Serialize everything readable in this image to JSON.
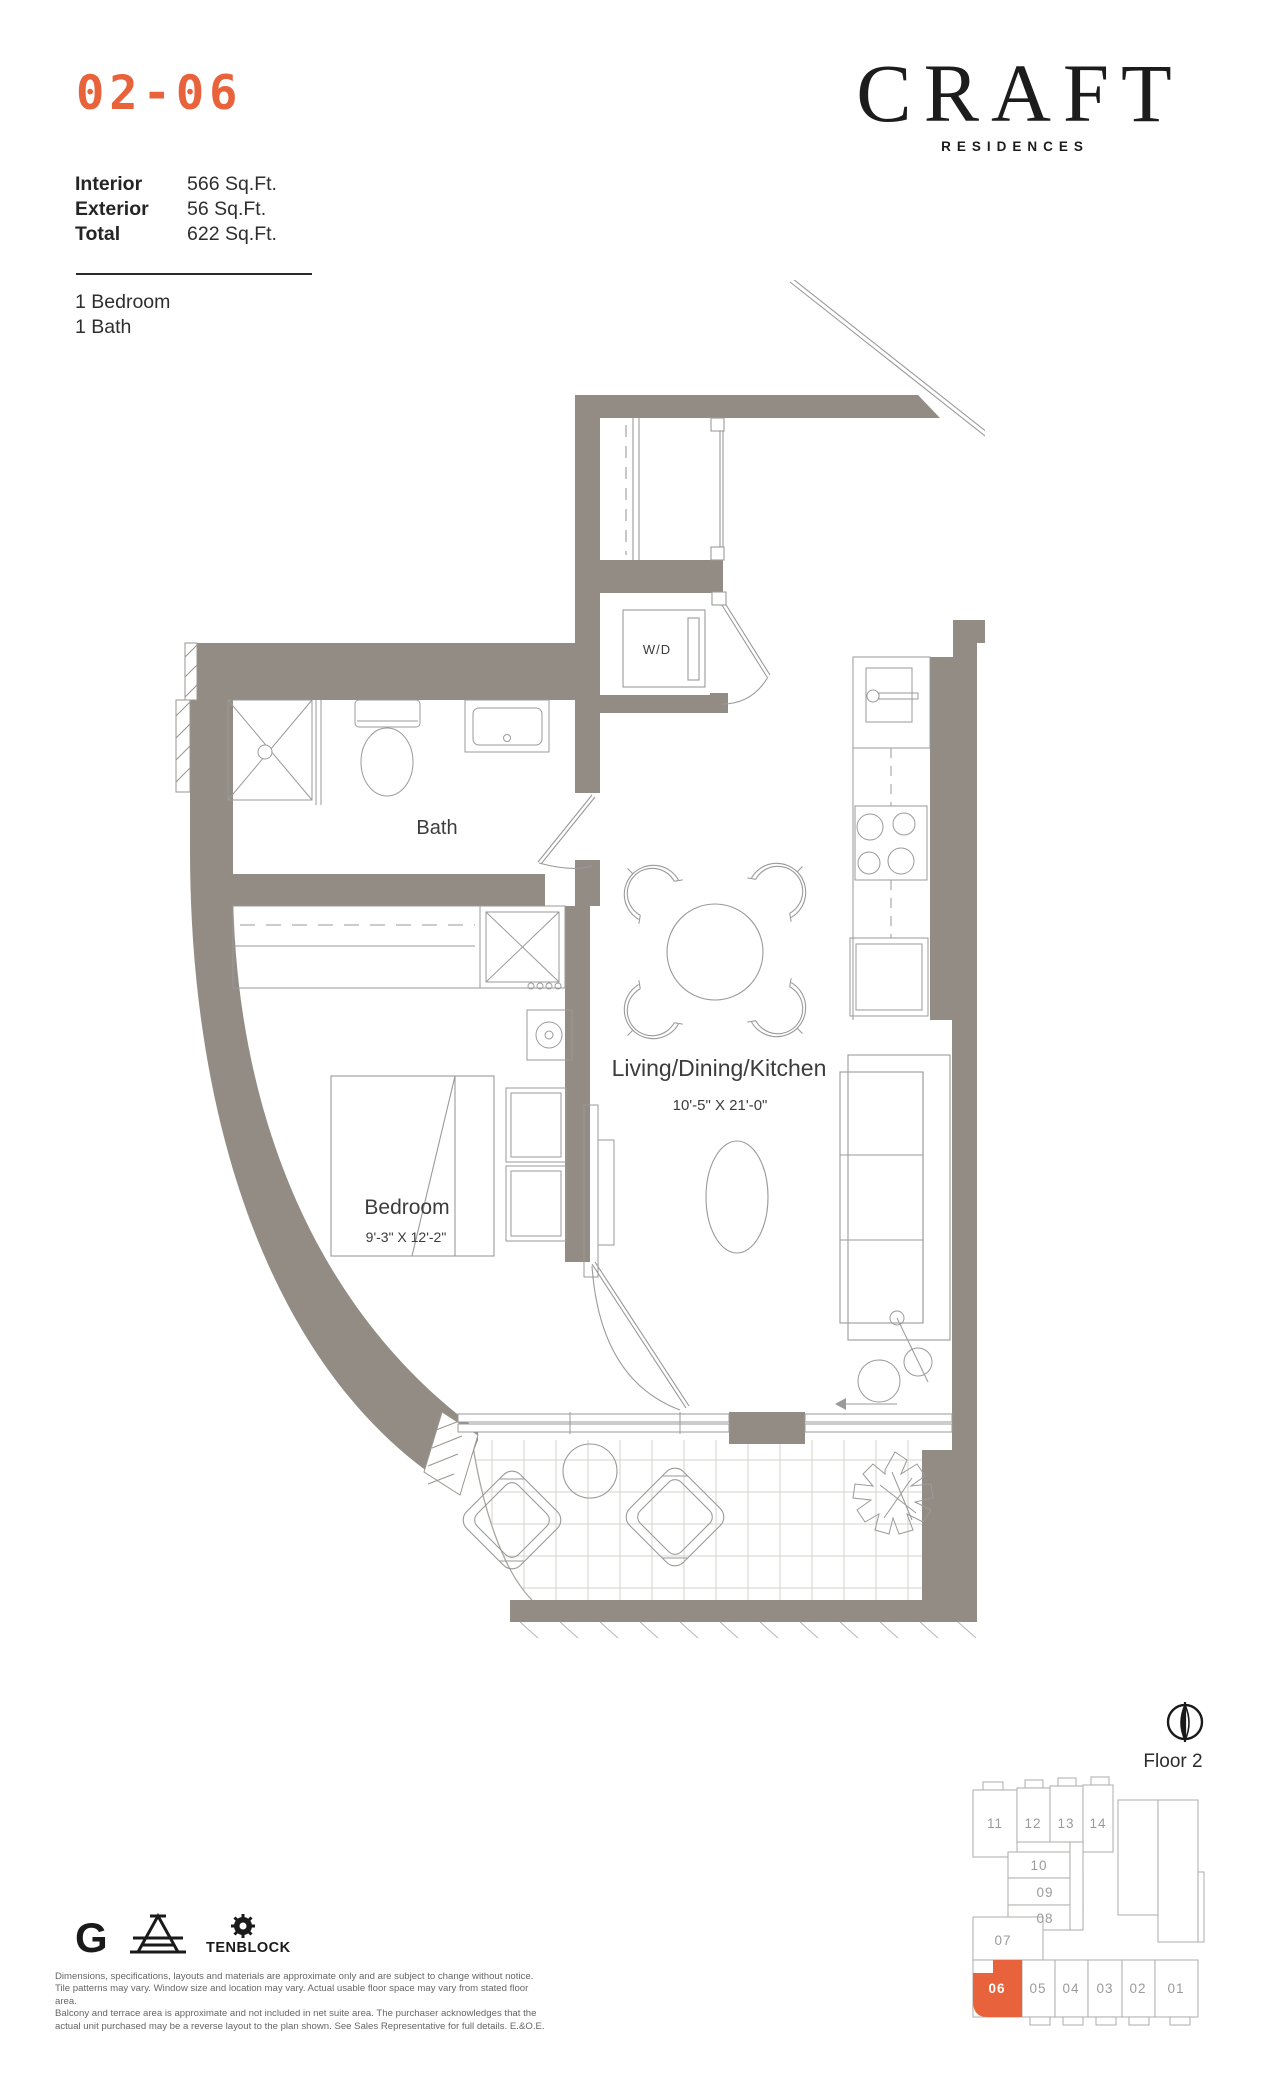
{
  "colors": {
    "accent": "#E8633B",
    "wall": "#938C84",
    "line": "#9A9A9A"
  },
  "unit": {
    "number": "02-06",
    "facts": [
      {
        "label": "Interior",
        "value": "566 Sq.Ft."
      },
      {
        "label": "Exterior",
        "value": "56 Sq.Ft."
      },
      {
        "label": "Total",
        "value": "622 Sq.Ft."
      }
    ],
    "config": [
      "1 Bedroom",
      "1 Bath"
    ]
  },
  "brand": {
    "wordmark": "CRAFT",
    "tagline": "RESIDENCES"
  },
  "plan": {
    "bath_label": "Bath",
    "wd_label": "W/D",
    "bedroom_label": "Bedroom",
    "bedroom_dims": "9'-3\" X 12'-2\"",
    "living_label": "Living/Dining/Kitchen",
    "living_dims": "10'-5\" X 21'-0\""
  },
  "keyplate": {
    "floor_label": "Floor 2",
    "highlighted_unit": "06",
    "units": [
      "11",
      "12",
      "13",
      "14",
      "10",
      "09",
      "08",
      "07",
      "06",
      "05",
      "04",
      "03",
      "02",
      "01"
    ]
  },
  "footer": {
    "logo_g": "G",
    "logo_tenblock": "TENBLOCK",
    "disclaimer": [
      "Dimensions, specifications, layouts and materials are approximate only and are subject to change without notice.",
      "Tile patterns may vary. Window size and location may vary. Actual usable floor space may vary from stated floor area.",
      "Balcony and terrace area is approximate and not included in net suite area. The purchaser acknowledges that the",
      "actual unit purchased may be a reverse layout to the plan shown. See Sales Representative for full details. E.&O.E."
    ]
  }
}
